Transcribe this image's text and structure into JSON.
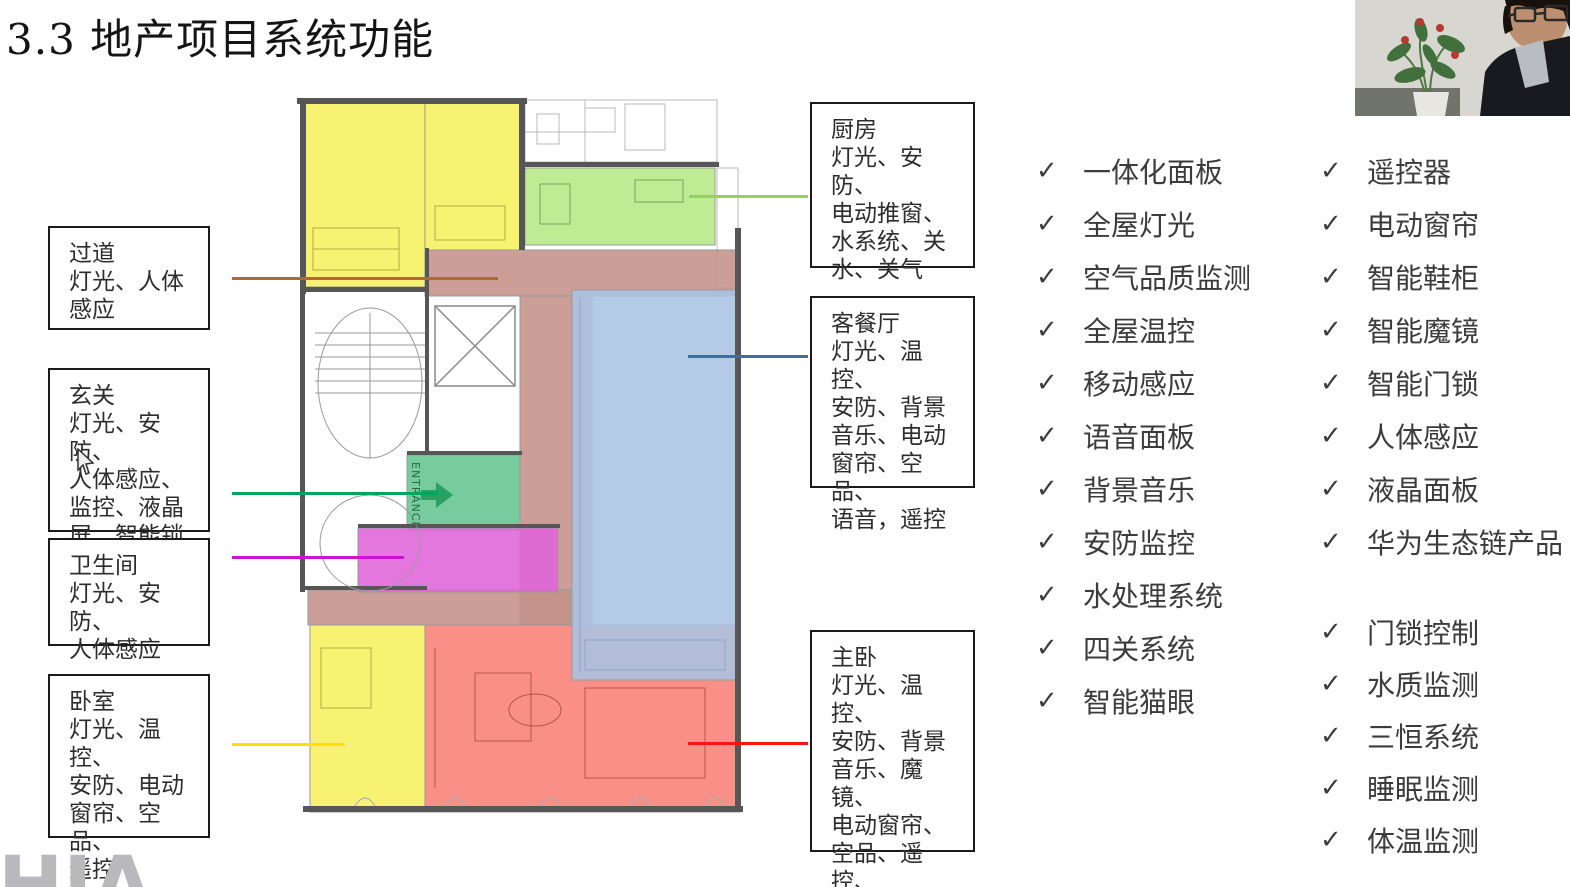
{
  "title": "3.3 地产项目系统功能",
  "watermark": "HIA",
  "floorplan": {
    "entrance_label": "ENTRANCE",
    "colors": {
      "bedroom_yellow": "#f6f05f",
      "kitchen_green": "#b7e886",
      "entrance_green": "#63c591",
      "bathroom_magenta": "#df64d8",
      "living_blue": "#a9c4e4",
      "master_red": "#f97f76",
      "corridor_mauve": "#c4928a"
    }
  },
  "room_labels": {
    "corridor": {
      "text": "过道\n灯光、人体\n感应",
      "line_color": "#b06a2e"
    },
    "entry": {
      "text": "玄关\n灯光、安防、\n人体感应、\n监控、液晶\n屏，智能锁",
      "line_color": "#00a65a"
    },
    "bathroom": {
      "text": "卫生间\n灯光、安防、\n人体感应",
      "line_color": "#cc14cc"
    },
    "bedroom": {
      "text": "卧室\n灯光、温控、\n安防、电动\n窗帘、空品、\n遥控",
      "line_color": "#ffe100"
    },
    "kitchen": {
      "text": "厨房\n灯光、安防、\n电动推窗、\n水系统、关\n水、关气",
      "line_color": "#90d653"
    },
    "living": {
      "text": "客餐厅\n灯光、温控、\n安防、背景\n音乐、电动\n窗帘、空品、\n语音，遥控",
      "line_color": "#3e6ea6"
    },
    "master": {
      "text": "主卧\n灯光、温控、\n安防、背景\n音乐、魔镜、\n电动窗帘、\n空品、遥控、\n智能鞋柜",
      "line_color": "#fb1510"
    }
  },
  "checklists": {
    "check_glyph": "✓",
    "col1": [
      "一体化面板",
      "全屋灯光",
      "空气品质监测",
      "全屋温控",
      "移动感应",
      "语音面板",
      "背景音乐",
      "安防监控",
      "水处理系统",
      "四关系统",
      "智能猫眼"
    ],
    "col2_top": [
      "遥控器",
      "电动窗帘",
      "智能鞋柜",
      "智能魔镜",
      "智能门锁",
      "人体感应",
      "液晶面板",
      "华为生态链产品"
    ],
    "col2_bottom": [
      "门锁控制",
      "水质监测",
      "三恒系统",
      "睡眠监测",
      "体温监测"
    ]
  }
}
